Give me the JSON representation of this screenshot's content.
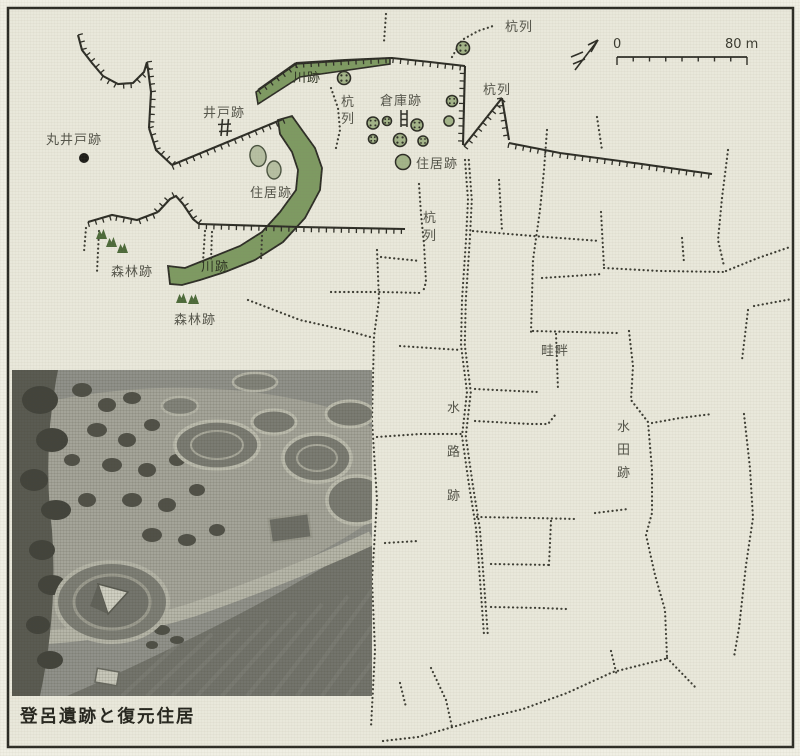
{
  "figure": {
    "caption": "登呂遺跡と復元住居"
  },
  "scale_bar": {
    "start_label": "0",
    "end_label": "80 m"
  },
  "legend_symbols": {
    "north_arrow": "north-arrow",
    "round_well_dot": "丸井戸跡",
    "well_hash": "井戸跡",
    "ladder_mark": "倉庫跡"
  },
  "map_labels": [
    {
      "id": "kuiretsu-top",
      "text": "杭列",
      "x": 505,
      "y": 31,
      "vertical": false
    },
    {
      "id": "kuiretsu-upper-right",
      "text": "杭列",
      "x": 483,
      "y": 94,
      "vertical": false
    },
    {
      "id": "kuiretsu-center",
      "text": "杭列",
      "x": 341,
      "y": 106,
      "vertical": true,
      "spacing": 17
    },
    {
      "id": "kuiretsu-middle",
      "text": "杭列",
      "x": 423,
      "y": 222,
      "vertical": true,
      "spacing": 18
    },
    {
      "id": "kawa-ato-upper",
      "text": "川跡",
      "x": 293,
      "y": 82,
      "vertical": false,
      "on_green": true
    },
    {
      "id": "kawa-ato-lower",
      "text": "川跡",
      "x": 201,
      "y": 271,
      "vertical": false,
      "on_green": true
    },
    {
      "id": "ido-ato",
      "text": "井戸跡",
      "x": 203,
      "y": 117,
      "vertical": false
    },
    {
      "id": "maru-ido-ato",
      "text": "丸井戸跡",
      "x": 46,
      "y": 144,
      "vertical": false
    },
    {
      "id": "jukyo-ato-left",
      "text": "住居跡",
      "x": 250,
      "y": 197,
      "vertical": false
    },
    {
      "id": "jukyo-ato-right",
      "text": "住居跡",
      "x": 416,
      "y": 168,
      "vertical": false
    },
    {
      "id": "soko-ato",
      "text": "倉庫跡",
      "x": 380,
      "y": 105,
      "vertical": false
    },
    {
      "id": "shinrin-ato-1",
      "text": "森林跡",
      "x": 111,
      "y": 276,
      "vertical": false
    },
    {
      "id": "shinrin-ato-2",
      "text": "森林跡",
      "x": 174,
      "y": 324,
      "vertical": false
    },
    {
      "id": "keihan",
      "text": "畦畔",
      "x": 541,
      "y": 355,
      "vertical": false
    },
    {
      "id": "suiro-ato",
      "text": "水路跡",
      "x": 447,
      "y": 412,
      "vertical": true,
      "spacing": 44
    },
    {
      "id": "suiden-ato",
      "text": "水田跡",
      "x": 617,
      "y": 431,
      "vertical": true,
      "spacing": 23
    }
  ],
  "colors": {
    "paper": "#e9e8db",
    "river_green": "#7e9a62",
    "circle_green": "#a3b489",
    "oval_green": "#b6bfa2",
    "tree_green": "#4d6a3a",
    "line_dark": "#2d2d26",
    "dot_dark": "#3c3c33",
    "label_gray": "#54544a"
  }
}
